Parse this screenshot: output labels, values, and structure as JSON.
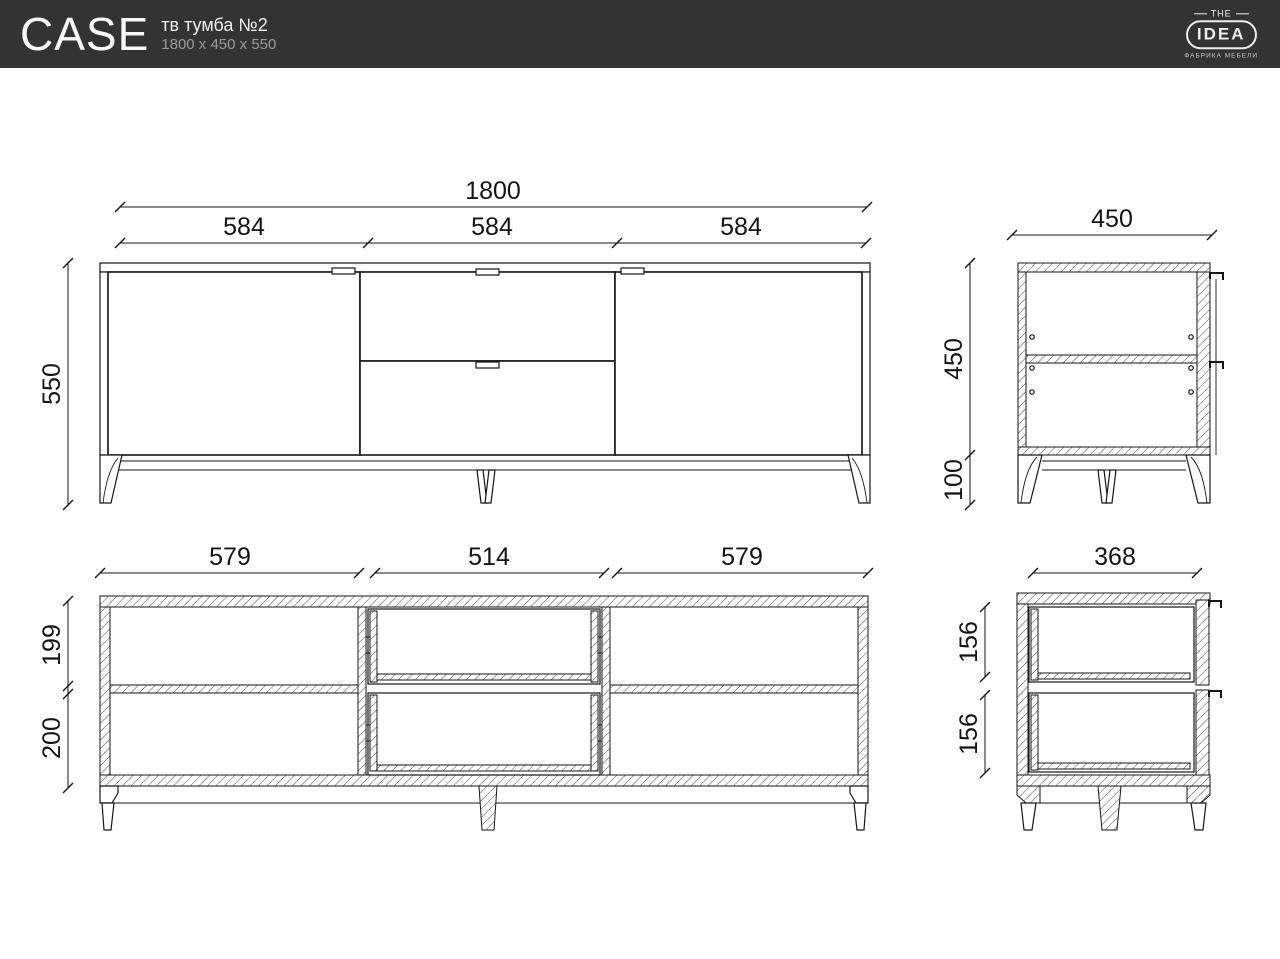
{
  "header": {
    "bg_color": "#333333",
    "product_name": "CASE",
    "product_type": "тв тумба №2",
    "product_size": "1800 x 450 x 550",
    "logo": {
      "top": "THE",
      "main": "IDEA",
      "subtitle": "ФАБРИКА МЕБЕЛИ"
    }
  },
  "views": {
    "front": {
      "overall_width": "1800",
      "section_widths": [
        "584",
        "584",
        "584"
      ],
      "overall_height": "550"
    },
    "side": {
      "width": "450",
      "body_height": "450",
      "leg_height": "100"
    },
    "front_section": {
      "compartment_widths": [
        "579",
        "514",
        "579"
      ],
      "upper_height": "199",
      "lower_height": "200"
    },
    "side_section": {
      "depth": "368",
      "drawer_heights": [
        "156",
        "156"
      ]
    }
  }
}
